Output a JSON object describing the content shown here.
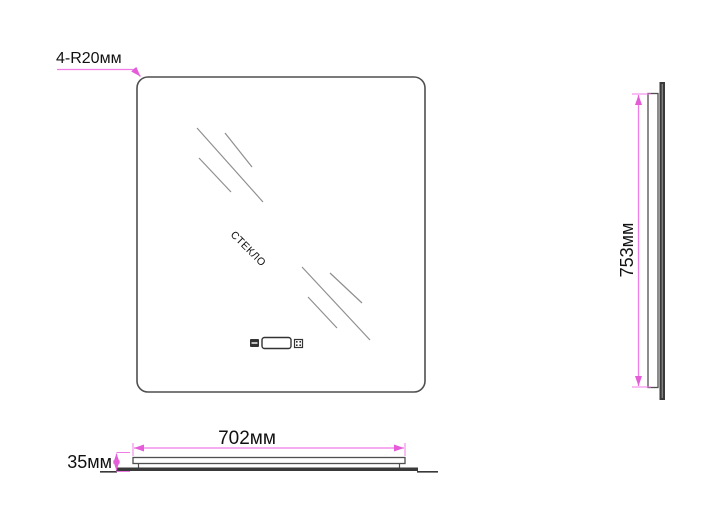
{
  "title": "mirror-technical-drawing",
  "labels": {
    "corner_radius": "4-R20мм",
    "glass": "СТЕКЛО",
    "height": "753мм",
    "width": "702мм",
    "depth": "35мм"
  },
  "dimensions_mm": {
    "width": 702,
    "height": 753,
    "depth": 35,
    "corner_radius": 20,
    "rounded_corners_count": 4
  },
  "icons": [
    "ir-sensor-icon",
    "display-window",
    "touch-switch-icon"
  ],
  "colors": {
    "background": "#ffffff",
    "outline": "#4f4f4f",
    "glass_edge": "#3a3a3a",
    "hatch": "#8f8f8f",
    "dimension_pink": "#f07ce8",
    "text": "#111111"
  }
}
